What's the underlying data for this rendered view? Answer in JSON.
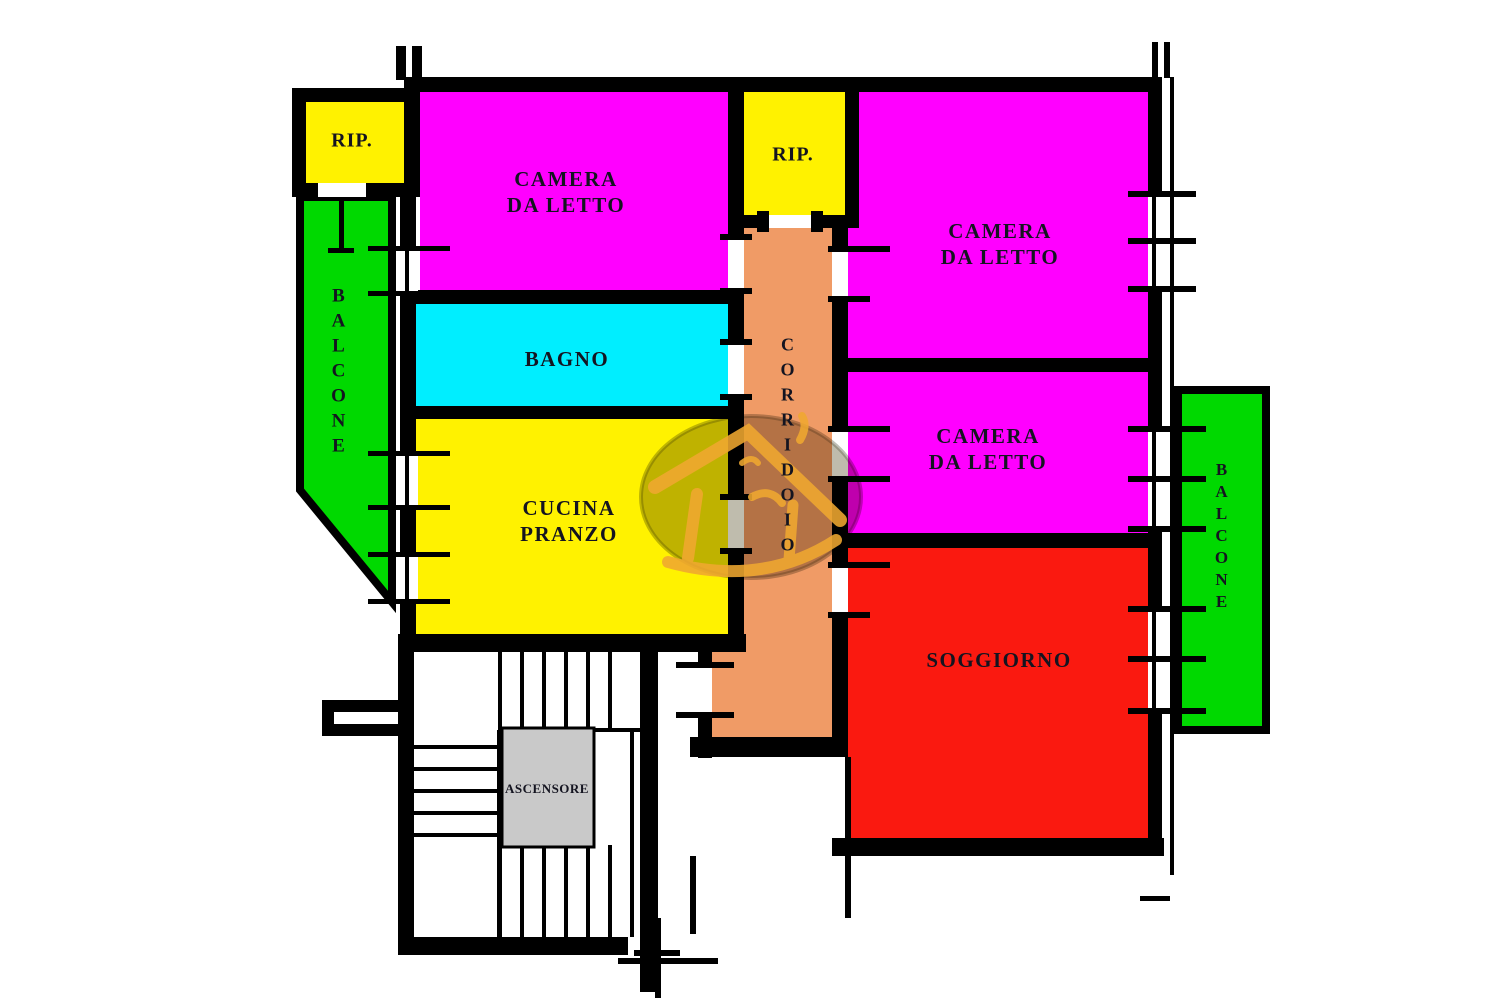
{
  "plan_title": "apartment-floor-plan",
  "rooms": {
    "rip1": {
      "label": "RIP."
    },
    "rip2": {
      "label": "RIP."
    },
    "camera1": {
      "label": "CAMERA\nDA LETTO"
    },
    "camera2": {
      "label": "CAMERA\nDA LETTO"
    },
    "camera3": {
      "label": "CAMERA\nDA LETTO"
    },
    "bagno": {
      "label": "BAGNO"
    },
    "cucina": {
      "label": "CUCINA\nPRANZO"
    },
    "soggiorno": {
      "label": "SOGGIORNO"
    },
    "corridoio": {
      "label": "CORRIDOIO"
    },
    "balcone_left": {
      "label": "BALCONE"
    },
    "balcone_right": {
      "label": "BALCONE"
    },
    "ascensore": {
      "label": "ASCENSORE"
    }
  },
  "colors": {
    "bedroom": "#FF00FF",
    "bath": "#00EEFF",
    "kitchen": "#FFF200",
    "storage": "#FFF200",
    "living": "#FA1910",
    "balcony": "#00D900",
    "corridor": "#F09B66",
    "elevator": "#C9C9C9",
    "walls": "#000000",
    "label_text": "#141420",
    "watermark_gold": "#F0A830"
  }
}
